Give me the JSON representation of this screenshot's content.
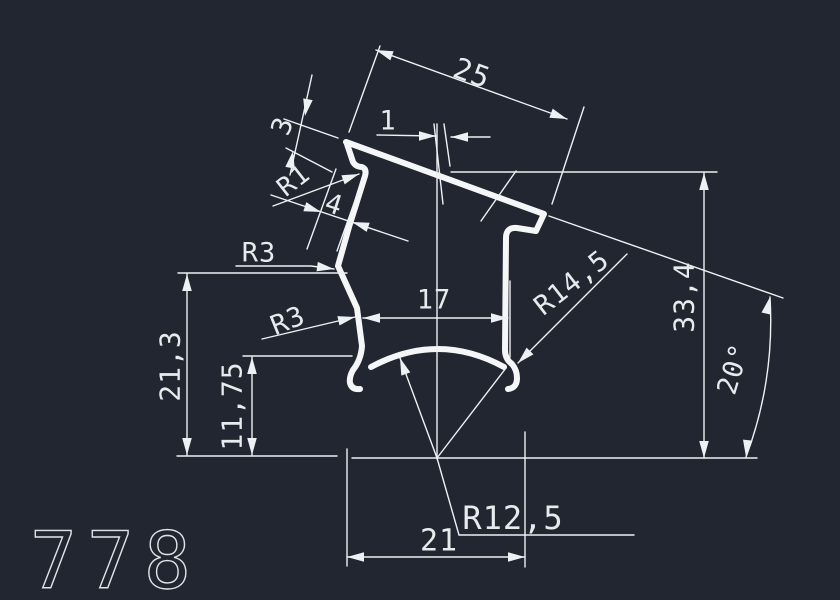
{
  "canvas": {
    "background_color": "#212631",
    "line_color": "#eef1f3",
    "text_color": "#e7ebee"
  },
  "drawing_number": "778",
  "labels": [
    {
      "name": "dim-25",
      "text": "25"
    },
    {
      "name": "dim-1",
      "text": "1"
    },
    {
      "name": "dim-3",
      "text": "3"
    },
    {
      "name": "radius-r1",
      "text": "R1"
    },
    {
      "name": "dim-4",
      "text": "4"
    },
    {
      "name": "radius-r3-upper",
      "text": "R3"
    },
    {
      "name": "radius-r3-lower",
      "text": "R3"
    },
    {
      "name": "dim-17",
      "text": "17"
    },
    {
      "name": "radius-r14-5",
      "text": "R14,5"
    },
    {
      "name": "dim-33-4",
      "text": "33,4"
    },
    {
      "name": "angle-20deg",
      "text": "20°"
    },
    {
      "name": "dim-21-3",
      "text": "21,3"
    },
    {
      "name": "dim-11-75",
      "text": "11,75"
    },
    {
      "name": "radius-r12-5",
      "text": "R12,5"
    },
    {
      "name": "dim-21",
      "text": "21"
    }
  ]
}
